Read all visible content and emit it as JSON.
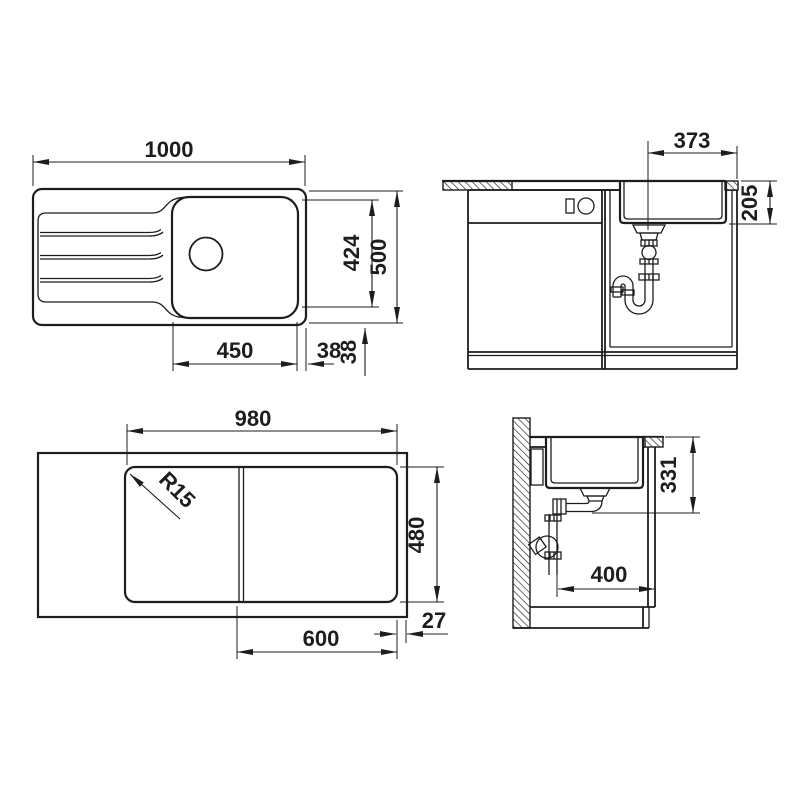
{
  "drawing": {
    "type": "sink-installation-technical-drawing",
    "line_color": "#1d1d1b",
    "background": "#ffffff"
  },
  "plan_view": {
    "overall_width": "1000",
    "overall_depth": "500",
    "bowl_depth": "424",
    "bowl_width": "450",
    "bowl_edge_gap": "38",
    "rim_edge_gap": "38"
  },
  "front_view": {
    "drain_center_offset": "373",
    "bowl_height": "205"
  },
  "underside_view": {
    "base_width": "980",
    "base_depth": "480",
    "cutout_span": "600",
    "edge_clearance": "27",
    "corner_radius": "R15"
  },
  "side_view": {
    "outlet_height": "331",
    "rear_clearance": "400"
  }
}
